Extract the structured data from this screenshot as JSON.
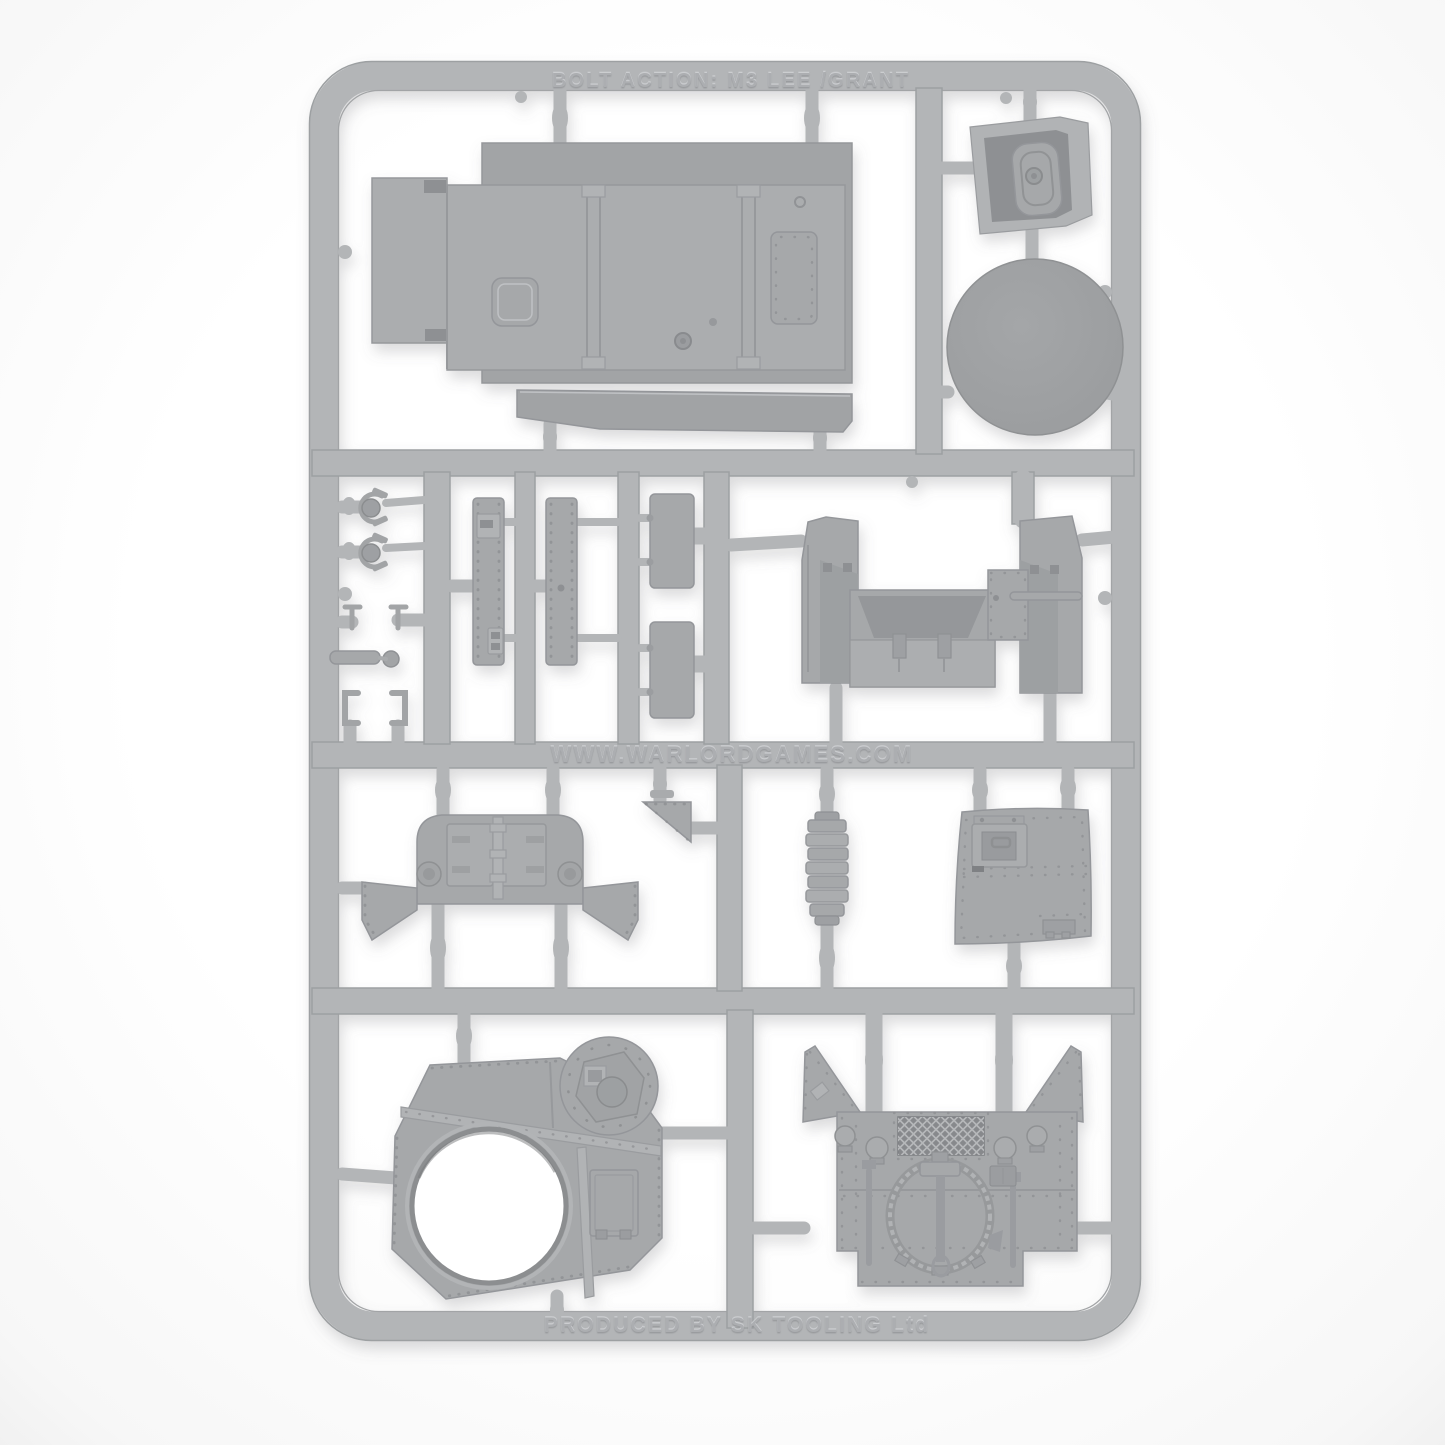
{
  "sprue": {
    "top_label": "BOLT ACTION: M3 LEE /GRANT",
    "middle_label": "WWW.WARLORDGAMES.COM",
    "bottom_label": "PRODUCED BY SK TOOLING Ltd"
  },
  "colors": {
    "background": "#ffffff",
    "plastic": "#b3b5b7",
    "plastic_part_light": "#abadaf",
    "plastic_part_mid": "#a6a8aa",
    "plastic_recess": "#8e9093"
  },
  "parts": [
    "hull-roof-panel",
    "hatch-interior-tub",
    "turret-ring-disc",
    "headlight-with-guard",
    "headlight-with-guard",
    "hook",
    "hook",
    "shackle-bar",
    "u-bracket",
    "u-bracket",
    "riveted-strip",
    "riveted-strip",
    "access-panel",
    "access-panel",
    "rear-hull-tub",
    "rear-plate-with-doors",
    "triangular-gusset",
    "exhaust-louvre-stack",
    "riveted-side-hatch-plate",
    "turret-top-plate-with-ring",
    "engine-deck-with-tools"
  ]
}
